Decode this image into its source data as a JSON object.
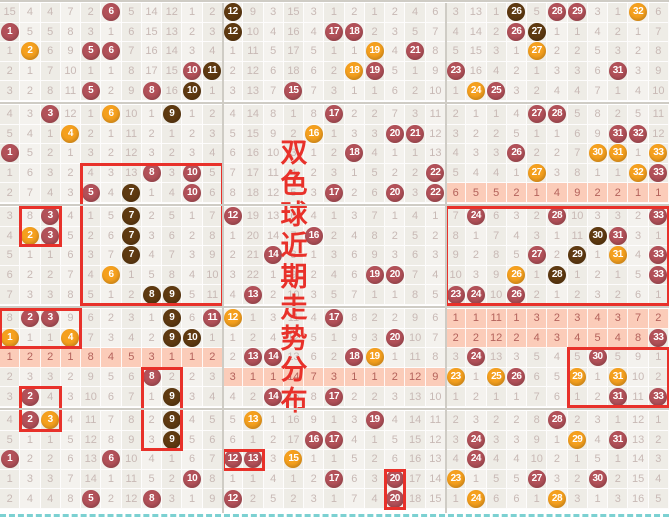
{
  "overlay_title": {
    "text": "双色球近期走势分布",
    "chars": [
      "双",
      "色",
      "球",
      "近",
      "期",
      "走",
      "势",
      "分",
      "布"
    ],
    "color": "#e8312a"
  },
  "colors": {
    "ball_maroon": "#b25159",
    "ball_orange": "#f5a01e",
    "ball_brown": "#5f3a11",
    "pink_highlight_bg": "#fbccb9",
    "pink_highlight_text": "#b4625b",
    "number_text": "#c8b9b5",
    "cell_bg": "#eeece6",
    "cell_bg_alt": "#f4f2ee",
    "separator": "#cfccc5",
    "red_box": "#e8312a",
    "bottom_dash": "#7cd1d2"
  },
  "grid": {
    "sections": 3,
    "columns_per_section": 11,
    "row_group_size": 5,
    "rows": [
      [
        "15",
        "4",
        "4",
        "7",
        "2",
        "6|m",
        "5",
        "14",
        "12",
        "1",
        "2",
        "12|k",
        "9",
        "3",
        "15",
        "3",
        "1",
        "2",
        "1",
        "2",
        "4",
        "6",
        "3",
        "13",
        "1",
        "26|k",
        "5",
        "28|m",
        "29|m",
        "3",
        "1",
        "32|o",
        "6"
      ],
      [
        "1|m",
        "5",
        "5",
        "8",
        "3",
        "1",
        "6",
        "15",
        "13",
        "2",
        "3",
        "12|k",
        "10",
        "4",
        "16",
        "4",
        "17|m",
        "18|m",
        "2",
        "3",
        "5",
        "7",
        "4",
        "14",
        "2",
        "26|m",
        "27|k",
        "1",
        "1",
        "4",
        "2",
        "1",
        "7"
      ],
      [
        "1",
        "2|o",
        "6",
        "9",
        "5|m",
        "6|m",
        "7",
        "16",
        "14",
        "3",
        "4",
        "1",
        "11",
        "5",
        "17",
        "5",
        "1",
        "1",
        "19|o",
        "4",
        "21|m",
        "8",
        "5",
        "15",
        "3",
        "1",
        "27|o",
        "2",
        "2",
        "5",
        "3",
        "2",
        "8"
      ],
      [
        "2",
        "1",
        "7",
        "10",
        "1",
        "1",
        "8",
        "17",
        "15",
        "10|m",
        "11|k",
        "2",
        "12",
        "6",
        "18",
        "6",
        "2",
        "18|o",
        "19|m",
        "5",
        "1",
        "9",
        "23|m",
        "16",
        "4",
        "2",
        "1",
        "3",
        "3",
        "6",
        "31|m",
        "3",
        "9"
      ],
      [
        "3",
        "2",
        "8",
        "11",
        "5|m",
        "2",
        "9",
        "8|m",
        "16",
        "10|k",
        "1",
        "3",
        "13",
        "7",
        "15|m",
        "7",
        "3",
        "1",
        "1",
        "6",
        "2",
        "10",
        "1",
        "24|o",
        "25|m",
        "3",
        "2",
        "4",
        "4",
        "7",
        "1",
        "4",
        "10"
      ],
      [
        "4",
        "3",
        "3|m",
        "12",
        "1",
        "6|o",
        "10",
        "1",
        "9|k",
        "1",
        "2",
        "4",
        "14",
        "8",
        "1",
        "8",
        "17|m",
        "2",
        "2",
        "7",
        "3",
        "11",
        "2",
        "1",
        "1",
        "4",
        "27|m",
        "28|m",
        "5",
        "8",
        "2",
        "5",
        "11"
      ],
      [
        "5",
        "4",
        "1",
        "4|o",
        "2",
        "1",
        "11",
        "2",
        "1",
        "2",
        "3",
        "5",
        "15",
        "9",
        "2",
        "16|o",
        "1",
        "3",
        "3",
        "20|m",
        "21|m",
        "12",
        "3",
        "2",
        "2",
        "5",
        "1",
        "1",
        "6",
        "9",
        "31|m",
        "32|m",
        "12"
      ],
      [
        "1|m",
        "5",
        "2",
        "1",
        "3",
        "2",
        "12",
        "3",
        "2",
        "3",
        "4",
        "6",
        "16",
        "10",
        "3",
        "1",
        "2",
        "18|m",
        "4",
        "1",
        "1",
        "13",
        "4",
        "3",
        "3",
        "26|m",
        "2",
        "2",
        "7",
        "30|o",
        "31|o",
        "1",
        "33|o"
      ],
      [
        "1",
        "6",
        "3",
        "2",
        "4",
        "3",
        "13",
        "8|m",
        "3",
        "10|m",
        "5",
        "7",
        "17",
        "11",
        "4",
        "2",
        "3",
        "1",
        "5",
        "2",
        "2",
        "22|m",
        "5",
        "4",
        "4",
        "1",
        "27|o",
        "3",
        "8",
        "1",
        "1",
        "32|o",
        "33|m"
      ],
      [
        "2",
        "7",
        "4",
        "3",
        "5|m",
        "4",
        "7|k",
        "1",
        "4",
        "10|m",
        "6",
        "8",
        "18",
        "12",
        "5",
        "3",
        "17|m",
        "2",
        "6",
        "20|m",
        "3",
        "22|m",
        "6|p",
        "5|p",
        "5|p",
        "2|p",
        "1|p",
        "4|p",
        "9|p",
        "2|p",
        "2|p",
        "1|p",
        "1|p"
      ],
      [
        "3",
        "8",
        "3|m",
        "4",
        "1",
        "5",
        "7|k",
        "2",
        "5",
        "1",
        "7",
        "12|m",
        "19",
        "13",
        "6",
        "4",
        "1",
        "3",
        "7",
        "1",
        "4",
        "1",
        "7",
        "24|m",
        "6",
        "3",
        "2",
        "28|m",
        "10",
        "3",
        "3",
        "2",
        "33|m"
      ],
      [
        "4",
        "2|o",
        "3|m",
        "5",
        "2",
        "6",
        "7|k",
        "3",
        "6",
        "2",
        "8",
        "1",
        "20",
        "14",
        "7",
        "16|m",
        "2",
        "4",
        "8",
        "2",
        "5",
        "2",
        "8",
        "1",
        "7",
        "4",
        "3",
        "1",
        "11",
        "30|k",
        "31|m",
        "3",
        "1"
      ],
      [
        "5",
        "1",
        "1",
        "6",
        "3",
        "7",
        "7|k",
        "4",
        "7",
        "3",
        "9",
        "2",
        "21",
        "14|m",
        "8",
        "1",
        "3",
        "6",
        "9",
        "3",
        "6",
        "3",
        "9",
        "2",
        "8",
        "5",
        "27|m",
        "2",
        "29|k",
        "1",
        "31|o",
        "4",
        "33|m"
      ],
      [
        "6",
        "2",
        "2",
        "7",
        "4",
        "6|o",
        "1",
        "5",
        "8",
        "4",
        "10",
        "3",
        "22",
        "1",
        "9",
        "2",
        "4",
        "6",
        "19|m",
        "20|m",
        "7",
        "4",
        "10",
        "3",
        "9",
        "26|o",
        "1",
        "28|k",
        "1",
        "2",
        "1",
        "5",
        "33|m"
      ],
      [
        "7",
        "3",
        "3",
        "8",
        "5",
        "1",
        "2",
        "8|k",
        "9|k",
        "5",
        "11",
        "4",
        "13|m",
        "2",
        "10",
        "3",
        "5",
        "7",
        "1",
        "1",
        "8",
        "5",
        "23|m",
        "24|m",
        "10",
        "26|m",
        "2",
        "1",
        "2",
        "3",
        "2",
        "6",
        "1"
      ],
      [
        "8",
        "2|m",
        "3|m",
        "9",
        "6",
        "2",
        "3",
        "1",
        "9|k",
        "6",
        "11|m",
        "12|o",
        "1",
        "3",
        "11",
        "4",
        "17|m",
        "8",
        "2",
        "2",
        "9",
        "6",
        "1|p",
        "1|p",
        "11|p",
        "1|p",
        "3|p",
        "2|p",
        "3|p",
        "4|p",
        "3|p",
        "7|p",
        "2|p"
      ],
      [
        "1|o",
        "1",
        "1",
        "4|o",
        "7",
        "3",
        "4",
        "2",
        "9|k",
        "10|k",
        "1",
        "1",
        "2",
        "4",
        "12",
        "5",
        "1",
        "9",
        "3",
        "20|m",
        "10",
        "7",
        "2|p",
        "2|p",
        "12|p",
        "2|p",
        "4|p",
        "3|p",
        "4|p",
        "5|p",
        "4|p",
        "8|p",
        "33|m"
      ],
      [
        "1|p",
        "2|p",
        "2|p",
        "1|p",
        "8|p",
        "4|p",
        "5|p",
        "3|p",
        "1|p",
        "1|p",
        "2|p",
        "2",
        "13|m",
        "14|m",
        "13",
        "6",
        "2",
        "18|m",
        "19|o",
        "1",
        "11",
        "8",
        "3",
        "24|m",
        "13",
        "3",
        "5",
        "4",
        "5",
        "30|m",
        "5",
        "9",
        "1"
      ],
      [
        "2",
        "3",
        "3",
        "2",
        "9",
        "5",
        "6",
        "8|m",
        "2",
        "2",
        "3",
        "3|p",
        "1|p",
        "1|p",
        "14|p",
        "7|p",
        "3|p",
        "1|p",
        "1|p",
        "2|p",
        "12|p",
        "9|p",
        "23|o",
        "1",
        "25|o",
        "26|m",
        "6",
        "5",
        "29|o",
        "1",
        "31|o",
        "10",
        "2"
      ],
      [
        "3",
        "2|m",
        "4",
        "3",
        "10",
        "6",
        "7",
        "1",
        "9|k",
        "3",
        "4",
        "4",
        "2",
        "14|m",
        "15",
        "8",
        "17|m",
        "2",
        "2",
        "3",
        "13",
        "10",
        "1",
        "2",
        "1",
        "1",
        "7",
        "6",
        "1",
        "2",
        "31|m",
        "11",
        "33|m"
      ],
      [
        "4",
        "2|m",
        "3|o",
        "4",
        "11",
        "7",
        "8",
        "2",
        "9|k",
        "4",
        "5",
        "5",
        "13|o",
        "1",
        "16",
        "9",
        "1",
        "3",
        "19|m",
        "4",
        "14",
        "11",
        "2",
        "3",
        "2",
        "2",
        "8",
        "28|m",
        "2",
        "3",
        "1",
        "12",
        "1"
      ],
      [
        "5",
        "1",
        "1",
        "5",
        "12",
        "8",
        "9",
        "3",
        "9|k",
        "5",
        "6",
        "6",
        "1",
        "2",
        "17",
        "16|m",
        "17|m",
        "4",
        "1",
        "5",
        "15",
        "12",
        "3",
        "24|m",
        "3",
        "3",
        "9",
        "1",
        "29|o",
        "4",
        "31|m",
        "13",
        "2"
      ],
      [
        "1|m",
        "2",
        "2",
        "6",
        "13",
        "6|m",
        "10",
        "4",
        "1",
        "6",
        "7",
        "12|m",
        "13|m",
        "3",
        "15|o",
        "1",
        "1",
        "5",
        "2",
        "6",
        "16",
        "13",
        "4",
        "24|m",
        "4",
        "4",
        "10",
        "2",
        "1",
        "5",
        "1",
        "14",
        "3"
      ],
      [
        "1",
        "3",
        "3",
        "7",
        "14",
        "1",
        "11",
        "5",
        "2",
        "10|m",
        "8",
        "1",
        "1",
        "4",
        "1",
        "2",
        "17|m",
        "6",
        "3",
        "20|m",
        "17",
        "14",
        "23|o",
        "1",
        "5",
        "5",
        "27|m",
        "3",
        "2",
        "30|m",
        "2",
        "15",
        "4"
      ],
      [
        "2",
        "4",
        "4",
        "8",
        "5|m",
        "2",
        "12",
        "8|m",
        "3",
        "1",
        "9",
        "12|m",
        "2",
        "5",
        "2",
        "3",
        "1",
        "7",
        "4",
        "20|m",
        "18",
        "15",
        "1",
        "24|o",
        "6",
        "6",
        "1",
        "28|o",
        "3",
        "1",
        "3",
        "16",
        "5"
      ]
    ]
  },
  "red_boxes": [
    {
      "rows": [
        9,
        15
      ],
      "cols": [
        5,
        11
      ]
    },
    {
      "rows": [
        11,
        12
      ],
      "cols": [
        2,
        3
      ]
    },
    {
      "rows": [
        16,
        17
      ],
      "cols": [
        1,
        4
      ]
    },
    {
      "rows": [
        20,
        21
      ],
      "cols": [
        2,
        3
      ]
    },
    {
      "rows": [
        19,
        22
      ],
      "cols": [
        8,
        9
      ]
    },
    {
      "rows": [
        23,
        23
      ],
      "cols": [
        12,
        13
      ]
    },
    {
      "rows": [
        24,
        25
      ],
      "cols": [
        20,
        20
      ]
    },
    {
      "rows": [
        11,
        15
      ],
      "cols": [
        23,
        33
      ]
    },
    {
      "rows": [
        18,
        20
      ],
      "cols": [
        29,
        33
      ]
    }
  ]
}
